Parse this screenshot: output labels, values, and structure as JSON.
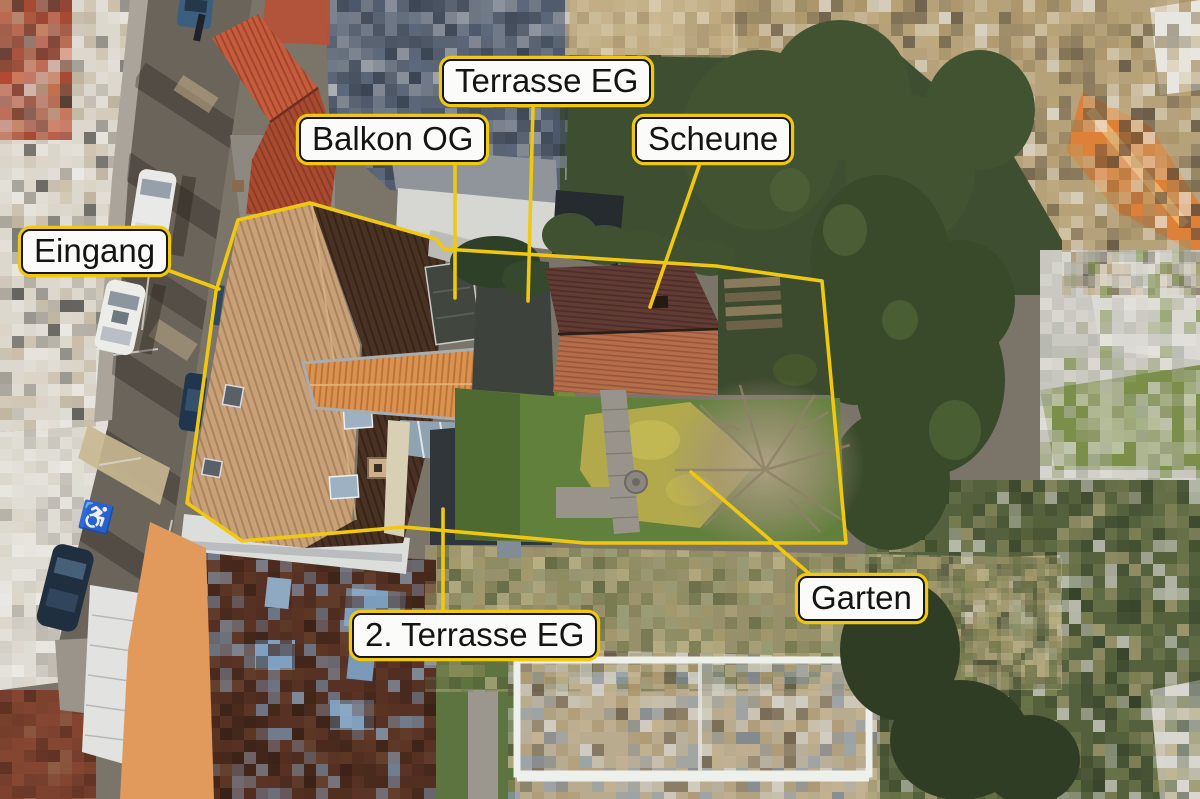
{
  "annotations": {
    "labels": {
      "terrasse_eg": "Terrasse EG",
      "balkon_og": "Balkon OG",
      "scheune": "Scheune",
      "eingang": "Eingang",
      "terrasse2_eg": "2. Terrasse EG",
      "garten": "Garten"
    },
    "colors": {
      "marker_yellow": "#f0c80f",
      "label_background": "#fbfbf9",
      "label_border": "#151515",
      "label_text": "#141414",
      "road_marking_white": "#e8e8e8"
    },
    "symbols": {
      "disabled_parking": "♿"
    }
  }
}
